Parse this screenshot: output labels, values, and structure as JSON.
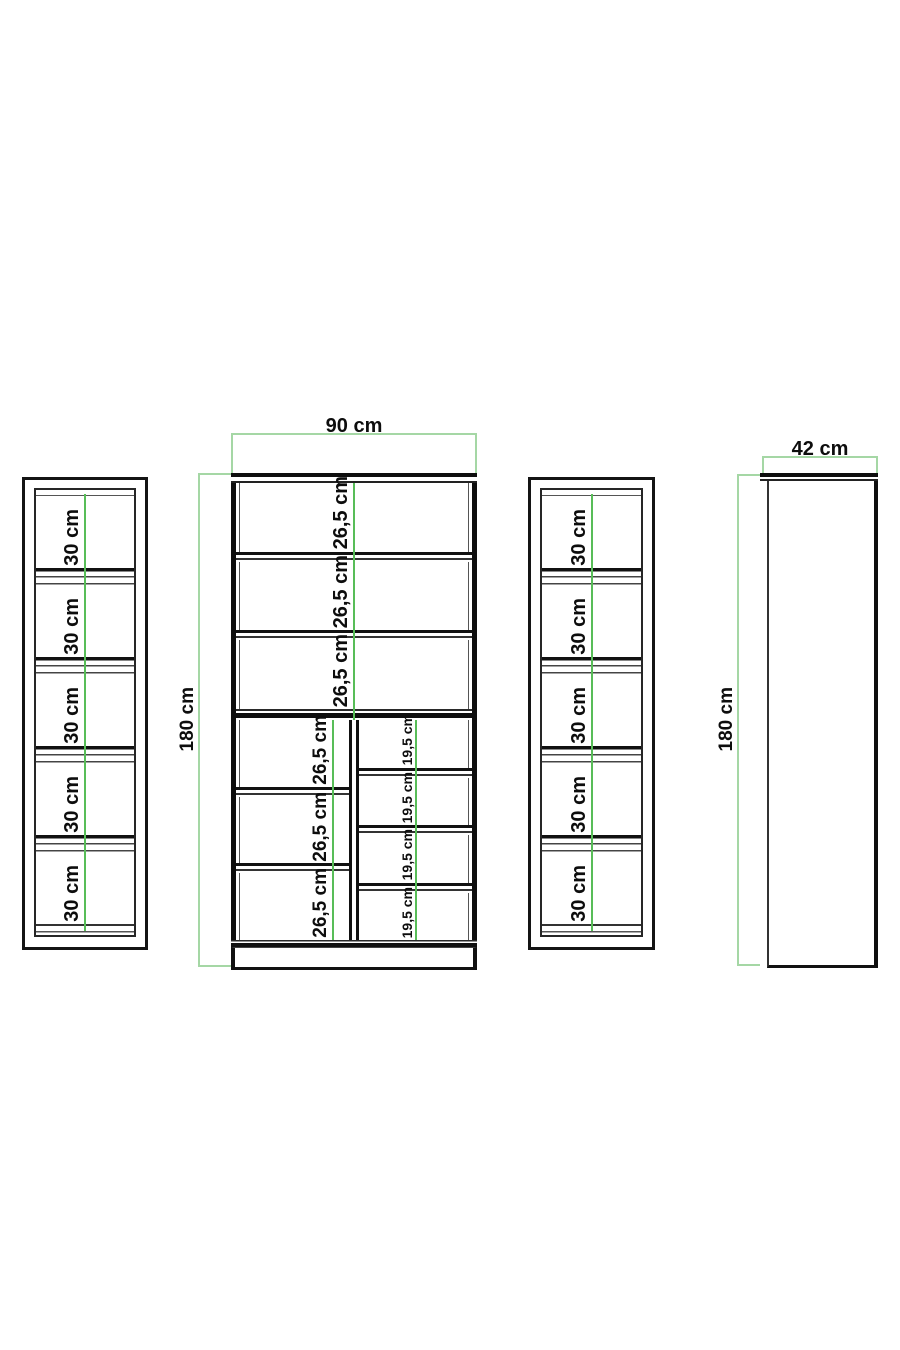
{
  "front_view": {
    "width_label": "90 cm",
    "height_label": "180 cm",
    "top_compartments": [
      "26,5 cm",
      "26,5 cm",
      "26,5 cm"
    ],
    "left_column_compartments": [
      "26,5 cm",
      "26,5 cm",
      "26,5 cm"
    ],
    "right_column_compartments": [
      "19,5 cm",
      "19,5 cm",
      "19,5 cm",
      "19,5 cm"
    ]
  },
  "left_panel_view": {
    "compartments": [
      "30 cm",
      "30 cm",
      "30 cm",
      "30 cm",
      "30 cm"
    ]
  },
  "middle_panel_view": {
    "compartments": [
      "30 cm",
      "30 cm",
      "30 cm",
      "30 cm",
      "30 cm"
    ]
  },
  "side_view": {
    "width_label": "42 cm",
    "height_label": "180 cm"
  },
  "colors": {
    "background": "#ffffff",
    "outline": "#141414",
    "dimension_bracket": "#a5d7a5",
    "center_guide_line": "#58bd58",
    "label_text": "#0d0d0d"
  }
}
